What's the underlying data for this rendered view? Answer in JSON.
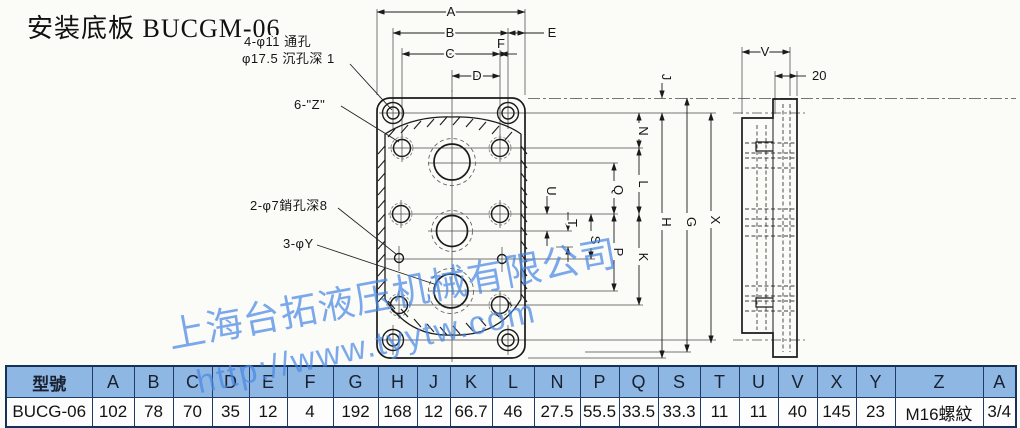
{
  "title": "安装底板 BUCGM-06",
  "watermark": {
    "company": "上海台拓液压机械有限公司",
    "url": "http://www.tyytw.com",
    "color": "#4888e4"
  },
  "annotations": {
    "through_holes": "4-φ11 通孔",
    "counterbore": "φ17.5 沉孔深 1",
    "thread_z": "6-\"Z\"",
    "pin_holes": "2-φ7銷孔深8",
    "port_y": "3-φY"
  },
  "dims": {
    "a": "A",
    "b": "B",
    "c": "C",
    "d": "D",
    "e": "E",
    "f": "F",
    "g": "G",
    "h": "H",
    "j": "J",
    "k": "K",
    "l": "L",
    "n": "N",
    "p": "P",
    "q": "Q",
    "s": "S",
    "t": "T",
    "u": "U",
    "v": "V",
    "x": "X",
    "twenty": "20"
  },
  "table": {
    "model_header": "型號",
    "headers": [
      "A",
      "B",
      "C",
      "D",
      "E",
      "F",
      "G",
      "H",
      "J",
      "K",
      "L",
      "N",
      "P",
      "Q",
      "S",
      "T",
      "U",
      "V",
      "X",
      "Y",
      "Z",
      "A"
    ],
    "row": {
      "model": "BUCG-06",
      "values": [
        "102",
        "78",
        "70",
        "35",
        "12",
        "4",
        "192",
        "168",
        "12",
        "66.7",
        "46",
        "27.5",
        "55.5",
        "33.5",
        "33.3",
        "11",
        "11",
        "40",
        "145",
        "23",
        "M16螺紋",
        "3/4"
      ]
    },
    "header_bg": "#8fb7e3",
    "border_color": "#1e3c66"
  }
}
